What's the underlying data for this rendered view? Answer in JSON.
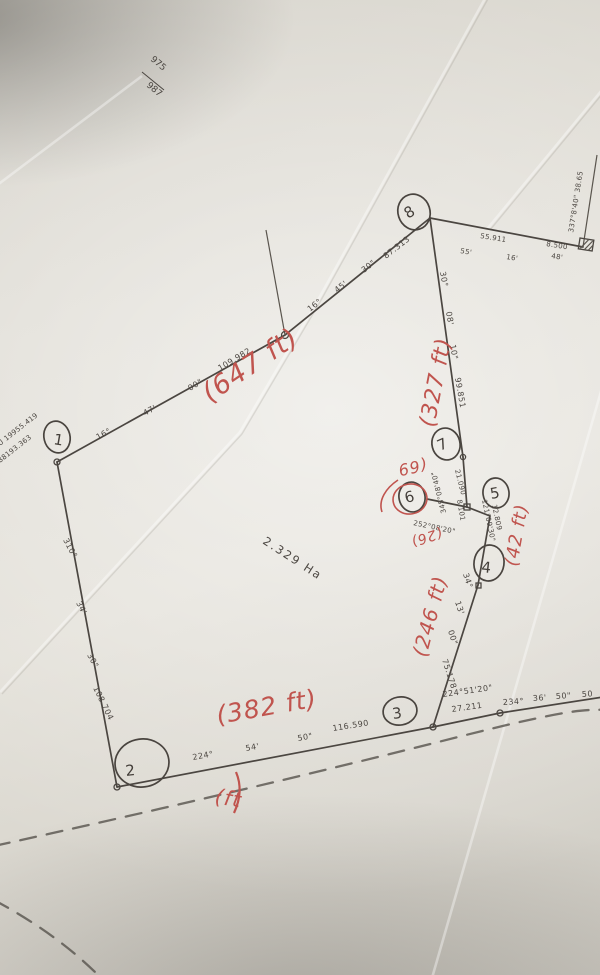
{
  "sheet": {
    "top": "975",
    "bottom": "987"
  },
  "corner_coordinates": {
    "line1": "U 19955.419",
    "line2": "88193.363"
  },
  "area_label": "2.329 Ha",
  "points": {
    "p1": "1",
    "p2": "2",
    "p3": "3",
    "p4": "4",
    "p5": "5",
    "p6": "6",
    "p7": "7",
    "p8": "8"
  },
  "bearings": {
    "seg_1_j": {
      "deg": "16°",
      "min": "47'",
      "sec": "00\"",
      "dist": "109.982"
    },
    "seg_j_8": {
      "deg": "16°",
      "min": "45'",
      "sec": "30\"",
      "dist": "87.313"
    },
    "seg_8_7": {
      "deg": "30°",
      "min": "08'",
      "sec": "10\"",
      "dist": "99.851"
    },
    "seg_7_a": {
      "bearing": "345°08'40\"",
      "dist": "21.090"
    },
    "seg_6_a": {
      "bearing": "252°08'20\"",
      "dist": "8.101"
    },
    "seg_a_5": {
      "bearing": "121°09'30\"",
      "dist": "12.809"
    },
    "seg_4_3": {
      "deg": "34°",
      "min": "13'",
      "sec": "00\"",
      "dist": "75.178"
    },
    "seg_3_b": {
      "bearing": "224°51'20\"",
      "dist": "27.211"
    },
    "road_line": {
      "deg": "234°",
      "min": "36'",
      "sec": "50\"",
      "extra": "50"
    },
    "seg_2_3": {
      "deg": "224°",
      "min": "54'",
      "sec": "50\"",
      "dist": "116.590"
    },
    "seg_1_2": {
      "deg": "310°",
      "min": "34'",
      "sec": "30\"",
      "dist": "108.704"
    },
    "seg_8_c": {
      "dist": "55.911",
      "min": "55'",
      "sec": "16'",
      "tie": "8.500",
      "tick": "48'"
    },
    "seg_c_up": {
      "text": "337°8'40\"  38.65"
    }
  },
  "red_notes": {
    "n647": "(647 ft)",
    "n327": "(327 ft)",
    "n69": "(69",
    "n26": "(26)",
    "n42": "(42 ft)",
    "n246": "(246 ft)",
    "n382": "(382 ft)",
    "nft": "(ft"
  },
  "colors": {
    "ink": "#4b4641",
    "red_pen": "#c0544e",
    "paper": "#dedbd3"
  }
}
